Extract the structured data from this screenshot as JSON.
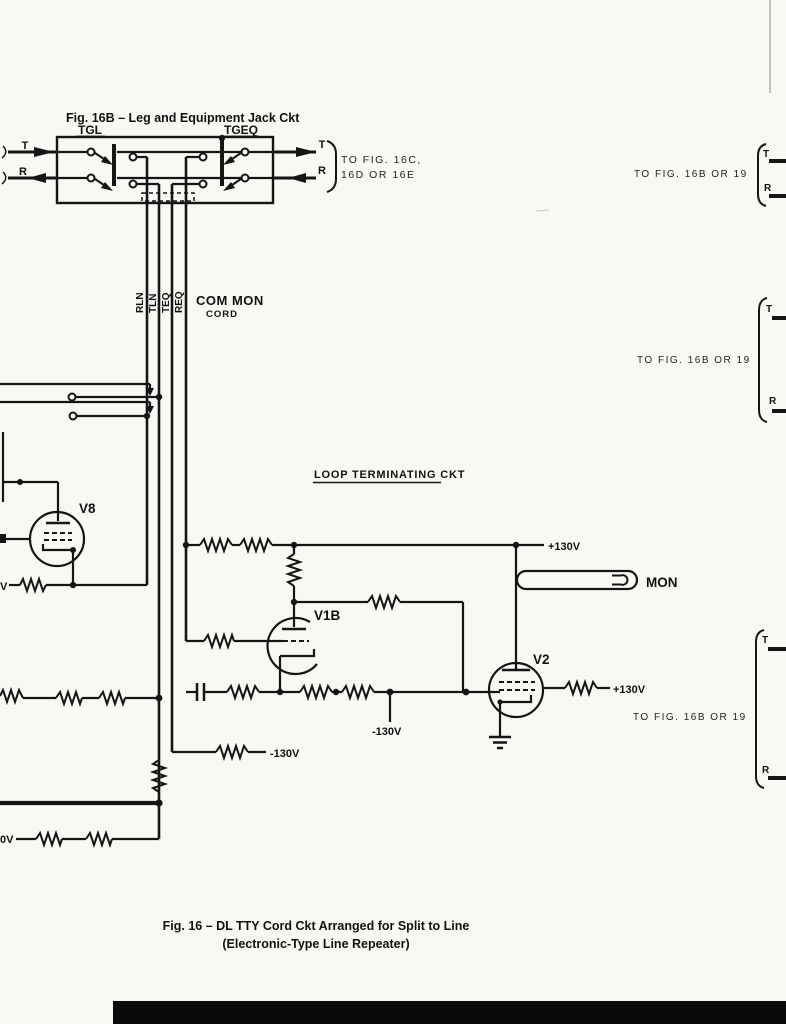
{
  "page": {
    "fig16b_title": "Fig. 16B – Leg and Equipment Jack Ckt",
    "loop_heading": "LOOP TERMINATING CKT",
    "caption_line1": "Fig. 16 – DL TTY Cord Ckt Arranged for Split to Line",
    "caption_line2": "(Electronic-Type Line Repeater)"
  },
  "jack": {
    "tgl": "TGL",
    "tgeq": "TGEQ",
    "t_in": "T",
    "r_in": "R",
    "t_out": "T",
    "r_out": "R",
    "dest_line1": "TO FIG. 16C,",
    "dest_line2": "16D OR 16E"
  },
  "cord": {
    "rln": "RLN",
    "tln": "TLN",
    "teq": "TEQ",
    "req": "REQ",
    "com_mon": "COM MON",
    "cord": "CORD"
  },
  "tubes": {
    "v8": "V8",
    "v1b": "V1B",
    "v2": "V2"
  },
  "lamp": {
    "mon": "MON"
  },
  "voltages": {
    "p130_top": "+130V",
    "p130_v2": "+130V",
    "n130_drop": "-130V",
    "n130_teq": "-130V",
    "v_partial": "V",
    "zero_v_partial": "0V"
  },
  "right_refs": {
    "ref1": "TO FIG. 16B OR 19",
    "ref2": "TO FIG. 16B OR 19",
    "ref3": "TO FIG. 16B OR 19",
    "t1": "T",
    "r1": "R",
    "t2": "T",
    "r2": "R",
    "t3": "T",
    "r3": "R"
  },
  "colors": {
    "ink": "#151515",
    "paper": "#f9f8f4",
    "footer_bar": "#0a0a0a"
  }
}
